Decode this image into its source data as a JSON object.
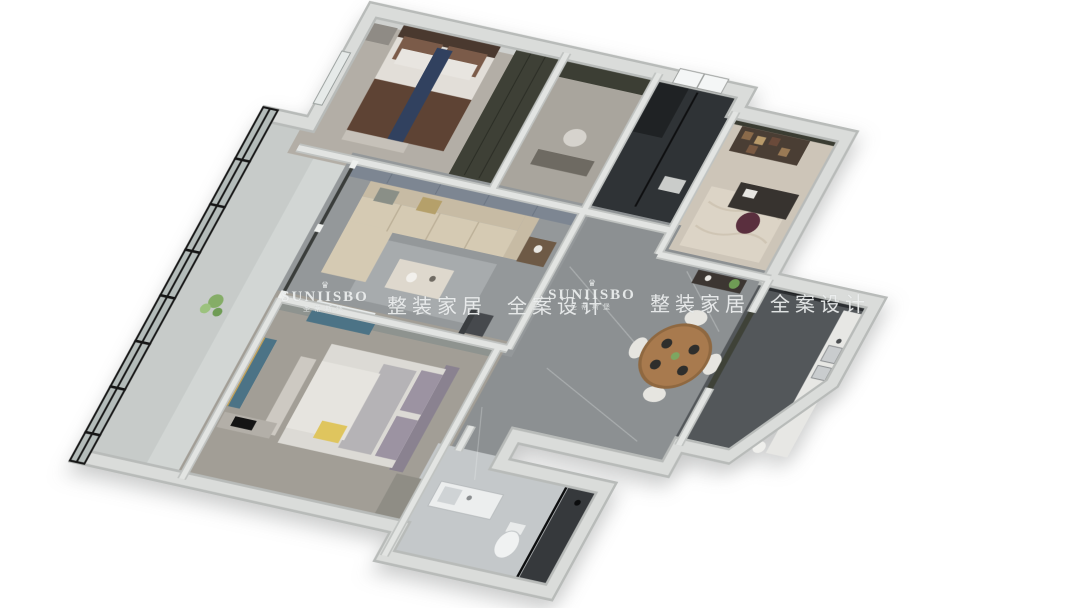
{
  "watermarks": {
    "brand": "SUNIISBO",
    "brand_cn": "圣蒂斯堡",
    "tagline": "整装家居 全案设计",
    "crown_icon": "♛",
    "color": "#eef1f1"
  },
  "scene": {
    "type": "3d-floorplan-render",
    "background": "#ffffff",
    "rooms": [
      "bedroom",
      "dressing-hall",
      "dark-bathroom",
      "study",
      "living-room",
      "balcony",
      "hallway-dining",
      "kitchen",
      "master-bedroom",
      "bathroom",
      "corridor"
    ],
    "palette": {
      "outer_wall": "#d9dbd9",
      "inner_wall": "#e2e4e2",
      "marble_floor": "#8c9092",
      "dark_bath": "#2f3336",
      "kitchen_floor": "#53575a",
      "sofa": "#d5cab3",
      "wood_table": "#a87a4e",
      "curtain_teal": "#4c7386",
      "glass_frame": "#161616",
      "plant_green": "#85ad67",
      "accent_yellow": "#dfc55e",
      "blanket_brown": "#5e4334"
    }
  }
}
